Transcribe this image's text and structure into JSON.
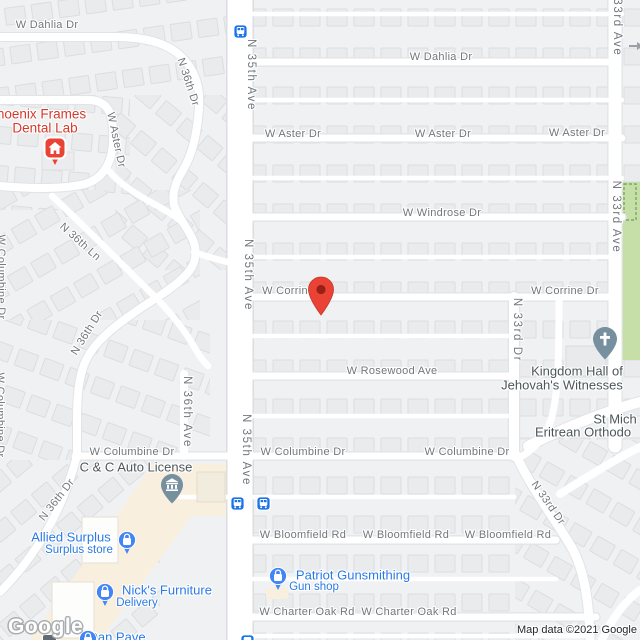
{
  "attribution": {
    "logo": "Google",
    "copyright": "Map data ©2021 Google"
  },
  "streets": [
    {
      "text": "W Dahlia Dr"
    },
    {
      "text": "W Dahlia Dr"
    },
    {
      "text": "W Aster Dr"
    },
    {
      "text": "W Aster Dr"
    },
    {
      "text": "W Aster Dr"
    },
    {
      "text": "W Aster Dr"
    },
    {
      "text": "W Windrose Dr"
    },
    {
      "text": "W Corrine Dr"
    },
    {
      "text": "W Corrine Dr"
    },
    {
      "text": "W Rosewood Ave"
    },
    {
      "text": "W Columbine Dr"
    },
    {
      "text": "W Columbine Dr"
    },
    {
      "text": "W Columbine Dr"
    },
    {
      "text": "W Bloomfield Rd"
    },
    {
      "text": "W Bloomfield Rd"
    },
    {
      "text": "W Bloomfield Rd"
    },
    {
      "text": "W Charter Oak Rd"
    },
    {
      "text": "W Charter Oak Rd"
    },
    {
      "text": "N 35th Ave"
    },
    {
      "text": "N 35th Ave"
    },
    {
      "text": "N 35th Ave"
    },
    {
      "text": "N 33rd Ave"
    },
    {
      "text": "N 33rd Ave"
    },
    {
      "text": "N 33rd Dr"
    },
    {
      "text": "N 33rd Dr"
    },
    {
      "text": "N 36th Dr"
    },
    {
      "text": "N 36th Ln"
    },
    {
      "text": "N 36th Dr"
    },
    {
      "text": "N 36th Dr"
    },
    {
      "text": "N 36th Ave"
    },
    {
      "text": "W Columbine Dr"
    },
    {
      "text": "W Columbine Dr"
    }
  ],
  "pois": [
    {
      "id": "phoenix-frames-dental-lab",
      "lines": [
        "Phoenix Frames",
        "Dental Lab"
      ]
    },
    {
      "id": "c-and-c-auto-license",
      "lines": [
        "C & C Auto License"
      ]
    },
    {
      "id": "allied-surplus",
      "lines": [
        "Allied Surplus",
        "Surplus store"
      ]
    },
    {
      "id": "nicks-furniture",
      "lines": [
        "Nick's Furniture",
        "Delivery"
      ]
    },
    {
      "id": "patriot-gunsmithing",
      "lines": [
        "Patriot Gunsmithing",
        "Gun shop"
      ]
    },
    {
      "id": "kingdom-hall",
      "lines": [
        "Kingdom Hall of",
        "Jehovah's Witnesses"
      ]
    },
    {
      "id": "st-michael-eritrean-orthodox",
      "lines": [
        "St Mich",
        "Eritrean Orthodo"
      ]
    },
    {
      "id": "dan-pave",
      "lines": [
        "Dan Pave"
      ]
    }
  ],
  "icons": {
    "marker": "red-map-pin",
    "dental": "house-icon",
    "civic": "bank-icon",
    "church": "cross-icon",
    "shopping": "bag-icon",
    "transit": "bus-icon",
    "oneway": "right-arrow-icon"
  },
  "colors": {
    "road": "#ffffff",
    "block": "#f0f1f3",
    "house": "#e9ebed",
    "park": "#c6dfa8",
    "commercial": "#f9efde",
    "street_label": "#72777b",
    "poi_blue": "#2a7ae4",
    "poi_slate": "#4b565c",
    "poi_red": "#d5392b",
    "pin_red": "#ea4335",
    "pin_slate": "#76909f",
    "pin_blue": "#4285f4",
    "transit_blue": "#1a73e8"
  }
}
